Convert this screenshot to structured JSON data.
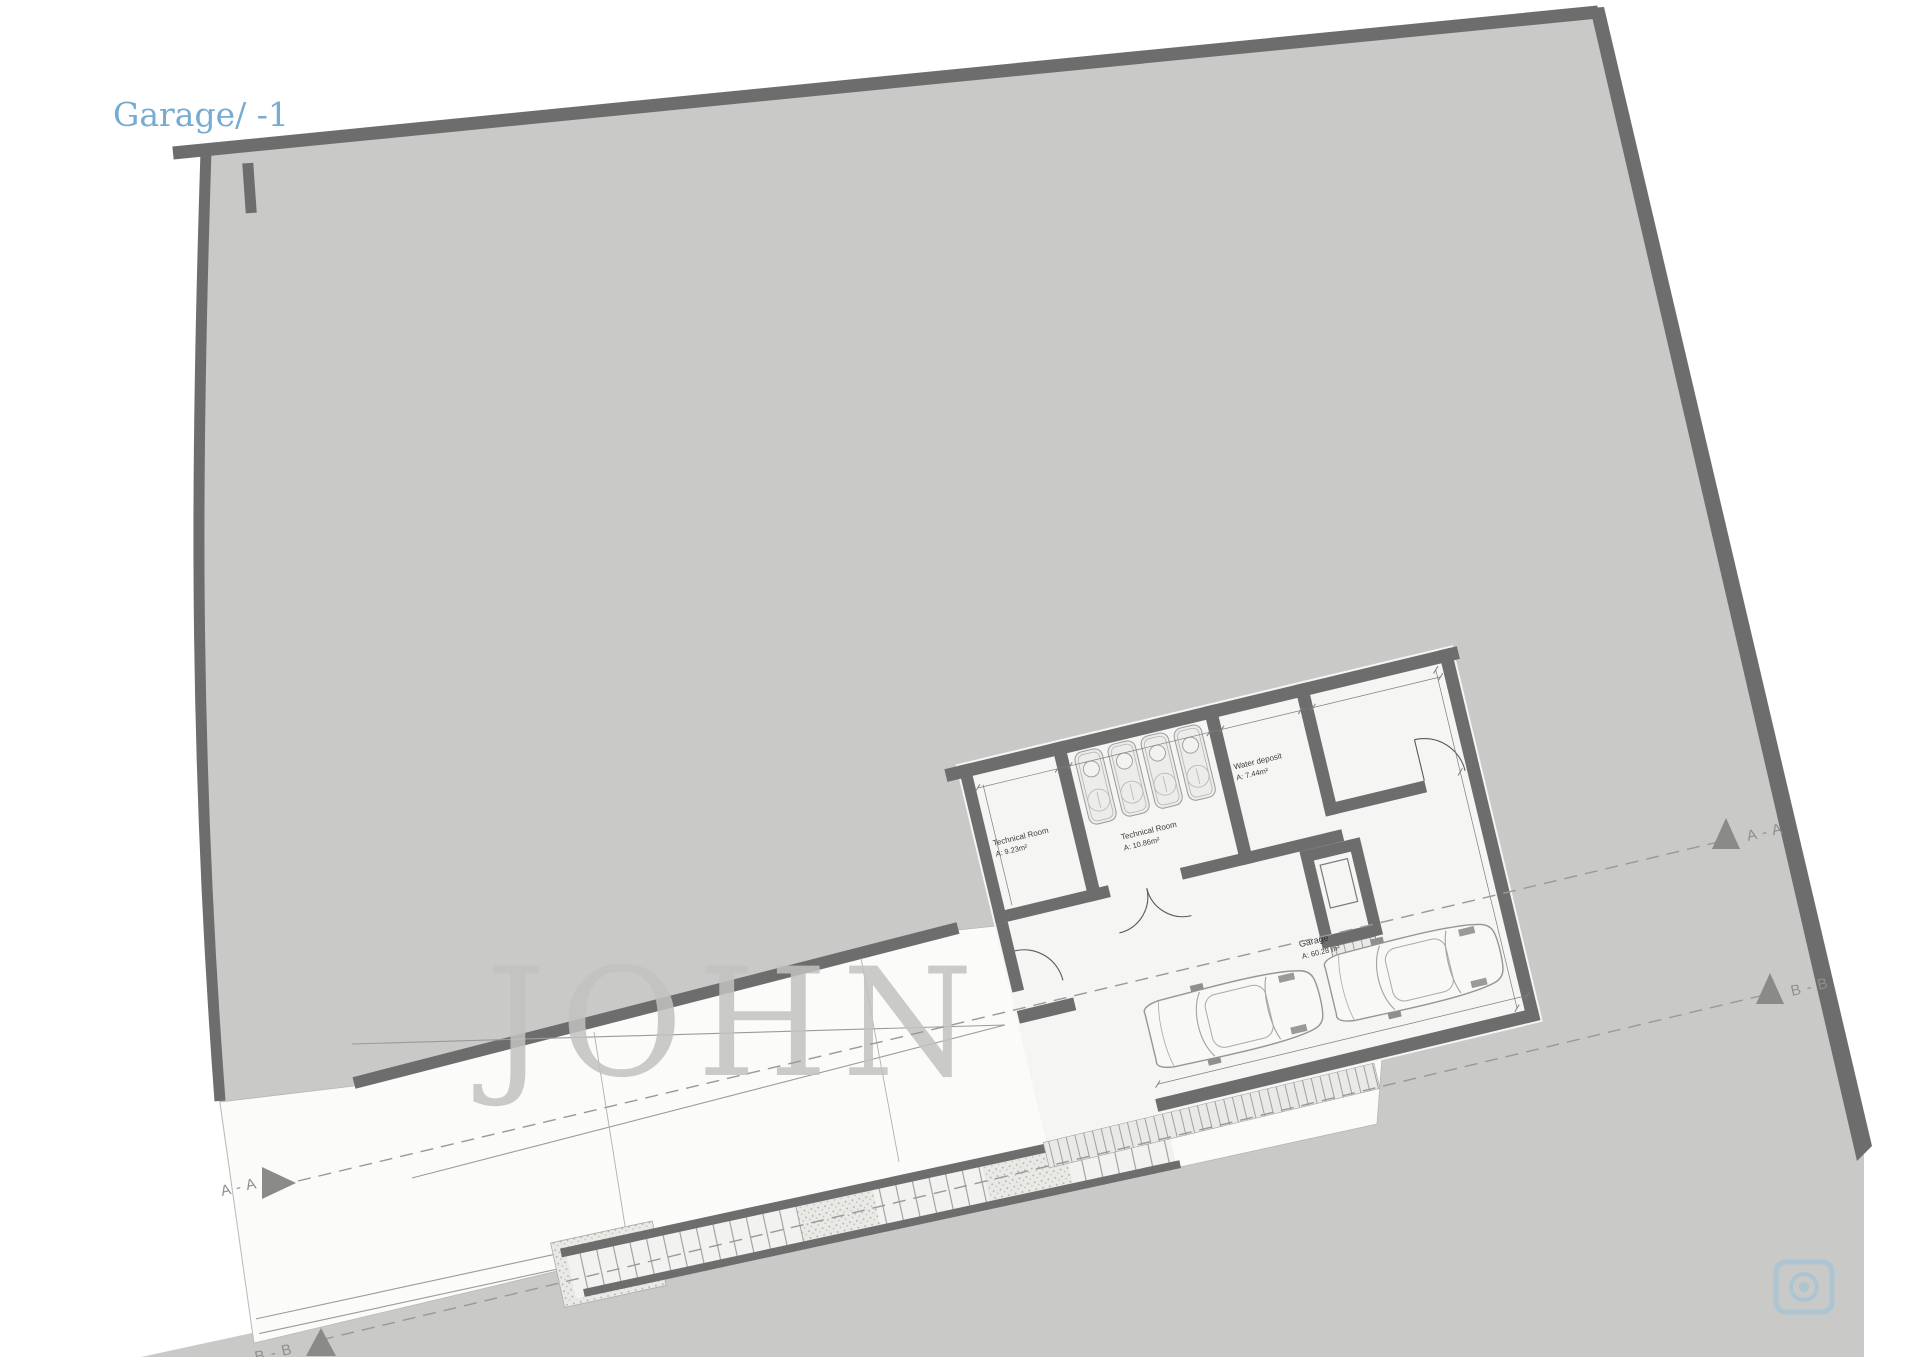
{
  "header": {
    "title": "Garage/ -1"
  },
  "plan": {
    "level": "-1",
    "rooms": {
      "technical_room_small": {
        "name": "Technical Room",
        "area": "A:  9.23m²"
      },
      "technical_room_large": {
        "name": "Technical Room",
        "area": "A:  10.86m²"
      },
      "water_deposit": {
        "name": "Water deposit",
        "area": "A:  7.44m²"
      },
      "garage": {
        "name": "Garage",
        "area": "A: 60.28 m²"
      }
    },
    "section_markers": {
      "aa_left": "A - A",
      "aa_right": "A - A",
      "bb_left": "B - B",
      "bb_right": "B - B"
    },
    "car_count": 2,
    "equipment_count": 4
  },
  "watermark": {
    "text": "JOHN"
  },
  "colors": {
    "title": "#76acd1",
    "site_fill": "#c9c9c7",
    "wall": "#6d6d6d",
    "floor": "#f5f5f3",
    "driveway": "#fbfbfa",
    "accent_icon": "#92c3e0"
  }
}
